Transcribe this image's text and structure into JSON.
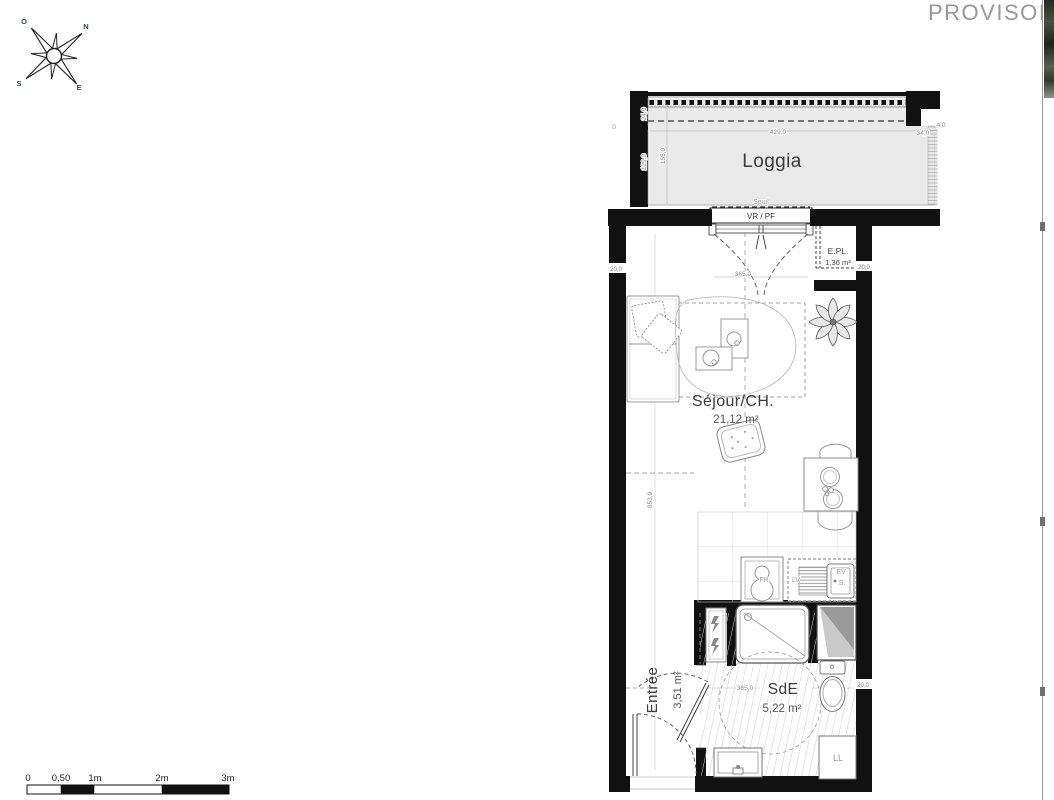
{
  "watermark": "PROVISOIRE",
  "compass": {
    "o": "O",
    "n": "N",
    "s": "S",
    "e": "E"
  },
  "rooms": {
    "loggia": {
      "name": "Loggia"
    },
    "sejour": {
      "name": "Séjour/CH.",
      "area": "21,12 m²"
    },
    "sde": {
      "name": "SdE",
      "area": "5,22 m²"
    },
    "entree": {
      "name": "Entrée",
      "area": "3,51 m²"
    },
    "epl": {
      "name": "E.PL.",
      "area": "1,36 m³"
    }
  },
  "labels": {
    "seuil": "Seuil",
    "window": "VR / PF",
    "fridge": "FR",
    "dishwasher": "LV",
    "sink": "EV",
    "siphon": "S.",
    "washer": "LL"
  },
  "dims": {
    "loggia_width": "429,0",
    "loggia_side": "34,0",
    "loggia_rail": "24,0",
    "loggia_d1": "129,0",
    "loggia_d2": "155,0",
    "zero": "0",
    "four": "4,0",
    "window_width": "365,0",
    "room_height": "853,9",
    "wall_left": "20,0",
    "wall_right": "20,0",
    "sde_width": "365,0",
    "sde_wall": "20,0"
  },
  "scalebar": {
    "labels": [
      "0",
      "0,50",
      "1m",
      "2m",
      "3m"
    ]
  },
  "colors": {
    "wall": "#111111",
    "loggia_fill": "#e9e9e9",
    "watermark": "#97989b"
  }
}
